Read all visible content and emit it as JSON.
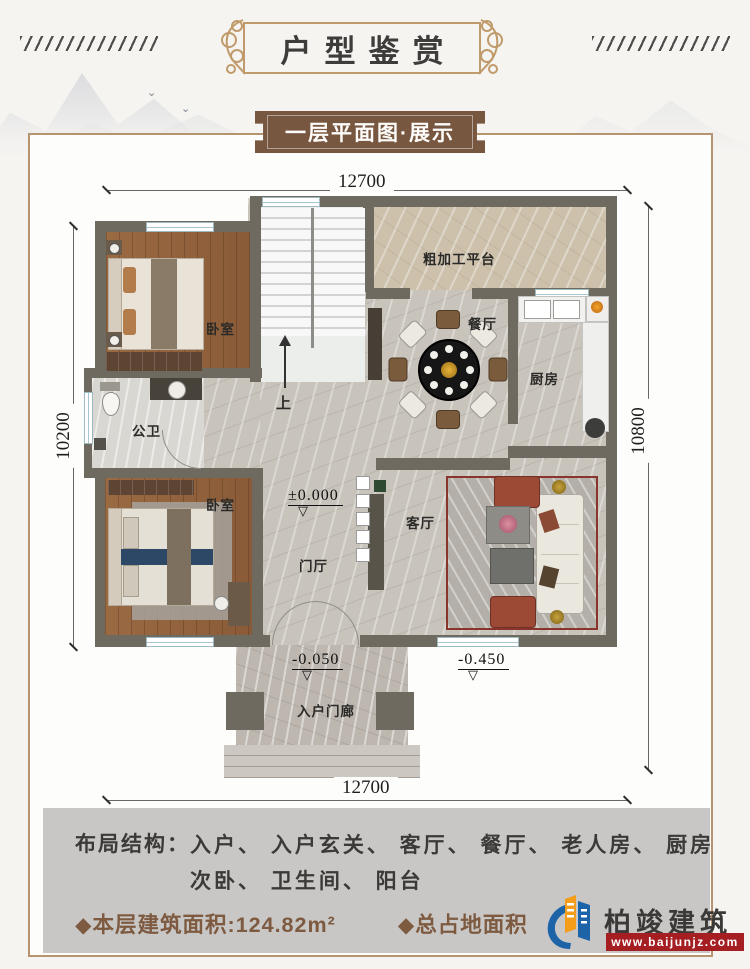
{
  "header": {
    "title": "户型鉴赏"
  },
  "banner": {
    "subtitle": "一层平面图·展示"
  },
  "plan": {
    "dims": {
      "top": "12700",
      "bottom": "12700",
      "left": "10200",
      "right": "10800"
    },
    "labels": {
      "platform": "粗加工平台",
      "dining": "餐厅",
      "kitchen": "厨房",
      "bedroom_top": "卧室",
      "bedroom_bottom": "卧室",
      "bathroom": "公卫",
      "living": "客厅",
      "foyer": "门厅",
      "porch": "入户门廊",
      "stair_up": "上"
    },
    "elevations": {
      "foyer": "±0.000",
      "porch": "-0.050",
      "terrace": "-0.450"
    }
  },
  "summary": {
    "layout_label": "布局结构：",
    "layout_line1": "入户、 入户玄关、 客厅、 餐厅、 老人房、 厨房",
    "layout_line2": "次卧、 卫生间、 阳台",
    "floor_area": "◆本层建筑面积:124.82m²",
    "total_area": "◆总占地面积"
  },
  "logo": {
    "name": "柏竣建筑",
    "website": "www.baijunjz.com"
  },
  "colors": {
    "banner_brown": "#785741",
    "frame_gold": "#c09a6a",
    "wall_gray": "#6e6a5f",
    "accent_brown": "#7d5a40",
    "logo_blue": "#1c63a8",
    "logo_orange": "#f49d1b",
    "logo_red": "#a51f22"
  }
}
